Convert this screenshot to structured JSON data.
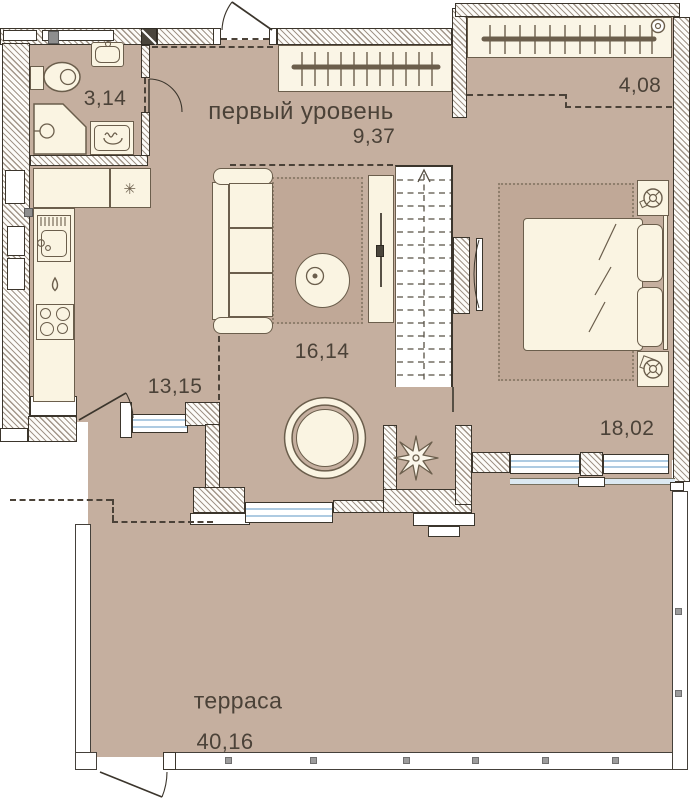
{
  "title": "первый уровень",
  "rooms": {
    "bathroom": {
      "area": "3,14"
    },
    "upper_hall": {
      "area": "9,37"
    },
    "balcony": {
      "area": "4,08"
    },
    "living": {
      "area": "16,14"
    },
    "hall": {
      "area": "13,15"
    },
    "bedroom": {
      "area": "18,02"
    },
    "terrace": {
      "name": "терраса",
      "area": "40,16"
    }
  },
  "icons": {
    "fridge_snowflake": "✳"
  },
  "colors": {
    "floor": "#c5af9f",
    "wall_outline": "#3b352c",
    "furniture_fill": "#faf4e2",
    "furniture_outline": "#6b5e4c",
    "window_glass": "#aecbe2",
    "text": "#4b4238"
  }
}
